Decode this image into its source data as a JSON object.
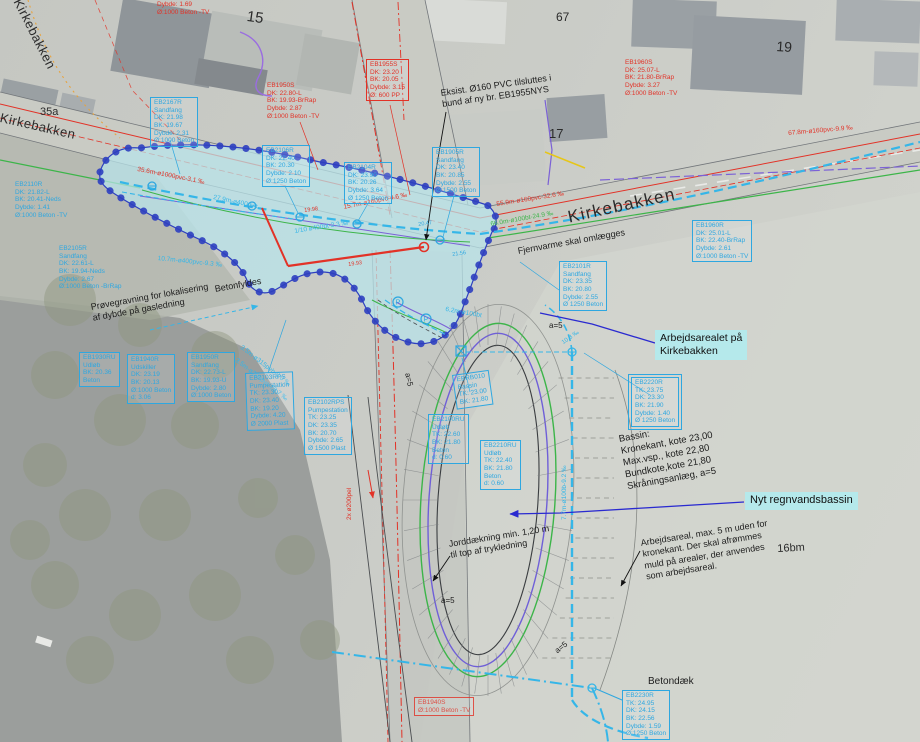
{
  "road_labels": {
    "main": "Kirkebakken",
    "top_left": "Kirkebakken",
    "left": "Kirkebakken"
  },
  "highlights": {
    "arbejdsarealet_line1": "Arbejdsarealet på",
    "arbejdsarealet_line2": "Kirkebakken",
    "nyt": "Nyt regnvandsbassin"
  },
  "colors": {
    "blue": "#2ea7e0",
    "red": "#e23227",
    "green": "#3cb549",
    "purple": "#7b61d6",
    "cyan": "#35b6e8",
    "darkblue": "#2a2ad0",
    "cloud": "#2d3fc0",
    "highlight": "#b5e9eb"
  },
  "house_numbers": [
    {
      "t": "15",
      "x": 248,
      "y": 8,
      "s": 15,
      "r": 8
    },
    {
      "t": "67",
      "x": 556,
      "y": 10,
      "s": 12,
      "r": 0
    },
    {
      "t": "19",
      "x": 777,
      "y": 38,
      "s": 14,
      "r": 4
    },
    {
      "t": "17",
      "x": 549,
      "y": 126,
      "s": 13,
      "r": 0
    },
    {
      "t": "35a",
      "x": 40,
      "y": 106,
      "s": 11,
      "r": 0
    },
    {
      "t": "16bm",
      "x": 777,
      "y": 543,
      "s": 11,
      "r": -3
    }
  ],
  "annotations": [
    {
      "lines": [
        "Eksist. Ø160 PVC tilsluttes i",
        "bund af ny br. EB1955NYS"
      ],
      "x": 440,
      "y": 88,
      "r": -8,
      "s": 9
    },
    {
      "lines": [
        "Fjernvarme skal omlægges"
      ],
      "x": 517,
      "y": 246,
      "r": -10,
      "s": 9
    },
    {
      "lines": [
        "Betonfyldes"
      ],
      "x": 214,
      "y": 284,
      "r": -10,
      "s": 9
    },
    {
      "lines": [
        "Prøvegravning for lokalisering",
        "af dybde på gasledning"
      ],
      "x": 90,
      "y": 302,
      "r": -10,
      "s": 9
    },
    {
      "lines": [
        "Bassin:",
        "Kronekant, kote 23,00",
        "Max.vsp., kote 22,80",
        "Bundkote,kote 21,80",
        "Skråningsanlæg, a=5"
      ],
      "x": 618,
      "y": 434,
      "r": -10,
      "s": 9.5
    },
    {
      "lines": [
        "Jorddækning min. 1,20 m",
        "til top af trykledning"
      ],
      "x": 448,
      "y": 539,
      "r": -9,
      "s": 9
    },
    {
      "lines": [
        "Arbejdsareal, max. 5 m uden for",
        "kronekant. Der skal afrømmes",
        "muld på arealer, der anvendes",
        "som arbejdsareal."
      ],
      "x": 640,
      "y": 538,
      "r": -9,
      "s": 9
    },
    {
      "lines": [
        "Betondæk"
      ],
      "x": 648,
      "y": 676,
      "r": 0,
      "s": 10
    },
    {
      "lines": [
        "a=5"
      ],
      "x": 549,
      "y": 321,
      "r": 0,
      "s": 8
    },
    {
      "lines": [
        "a=5"
      ],
      "x": 412,
      "y": 372,
      "r": 78,
      "s": 8
    },
    {
      "lines": [
        "a=5"
      ],
      "x": 441,
      "y": 596,
      "r": 0,
      "s": 8
    },
    {
      "lines": [
        "a=5"
      ],
      "x": 553,
      "y": 648,
      "r": -38,
      "s": 8
    }
  ],
  "pipe_labels": [
    {
      "t": "67.8m-ø160pvc-9.9 ‰",
      "x": 788,
      "y": 130,
      "r": -5,
      "c": "red"
    },
    {
      "t": "55.9m-ø160pvc-32.6 ‰",
      "x": 496,
      "y": 201,
      "r": -9,
      "c": "red"
    },
    {
      "t": "66.0m-ø100bt-24.9 ‰",
      "x": 490,
      "y": 221,
      "r": -10,
      "c": "green"
    },
    {
      "t": "35.6m-ø1000pvc-3.1 ‰",
      "x": 138,
      "y": 166,
      "r": 11,
      "c": "red"
    },
    {
      "t": "27.9m-ø400pvc",
      "x": 214,
      "y": 194,
      "r": 12,
      "c": "cyan"
    },
    {
      "t": "10.7m-ø400pvc-9.3 ‰",
      "x": 158,
      "y": 255,
      "r": 6,
      "c": "cyan"
    },
    {
      "t": "15.7m-ø160pvc-4.6 ‰",
      "x": 343,
      "y": 204,
      "r": -11,
      "c": "red"
    },
    {
      "t": "1/10 ø400bt-2.3 ‰",
      "x": 294,
      "y": 228,
      "r": -9,
      "c": "cyan"
    },
    {
      "t": "3.5m-ø315peh-0.0 ‰",
      "x": 243,
      "y": 344,
      "r": 38,
      "c": "cyan"
    },
    {
      "t": "3.5m-ø200pvc-26.7 ‰",
      "x": 238,
      "y": 357,
      "r": 38,
      "c": "cyan"
    },
    {
      "t": "7.7m-ø100b-9.2 ‰",
      "x": 561,
      "y": 520,
      "r": -90,
      "c": "cyan"
    },
    {
      "t": "2x ø200pel",
      "x": 346,
      "y": 520,
      "r": -90,
      "c": "red"
    },
    {
      "t": "6.2m-ø100bt",
      "x": 446,
      "y": 306,
      "r": 10,
      "c": "cyan"
    },
    {
      "t": "10.3 ‰",
      "x": 561,
      "y": 341,
      "r": -35,
      "c": "cyan",
      "s": 6
    },
    {
      "t": "19.98",
      "x": 304,
      "y": 208,
      "r": -8,
      "c": "red",
      "s": 5.5
    },
    {
      "t": "19.93",
      "x": 348,
      "y": 262,
      "r": -8,
      "c": "red",
      "s": 5.5
    },
    {
      "t": "20.47",
      "x": 418,
      "y": 222,
      "r": -8,
      "c": "blue",
      "s": 5.5
    },
    {
      "t": "21.56",
      "x": 452,
      "y": 252,
      "r": -8,
      "c": "blue",
      "s": 5.5
    }
  ],
  "manhole_boxes": [
    {
      "id": "EB2167R",
      "style": "b",
      "x": 150,
      "y": 97,
      "lines": [
        "EB2167R",
        "Sandfang",
        "DK: 21.98",
        "BK: 19.67",
        "Dybde: 2.31",
        "Ø:1000 Beton"
      ]
    },
    {
      "id": "EB1950S",
      "style": "rb",
      "x": 267,
      "y": 82,
      "lines": [
        "EB1950S",
        "DK: 22.80-L",
        "BK: 19.93-BrRap",
        "Dybde: 2.87",
        "Ø:1000 Beton -TV"
      ]
    },
    {
      "id": "EB1955S",
      "style": "r",
      "x": 366,
      "y": 59,
      "lines": [
        "EB1955S",
        "DK: 23.20",
        "BK: 20.05",
        "Dybde: 3.15",
        "Ø: 600 PP"
      ]
    },
    {
      "id": "EB2106R",
      "style": "b",
      "x": 262,
      "y": 145,
      "lines": [
        "EB2106R",
        "DK: 22.40",
        "BK: 20.30",
        "Dybde: 2.10",
        "Ø:1250 Beton"
      ]
    },
    {
      "id": "EB2104R",
      "style": "b",
      "x": 344,
      "y": 162,
      "lines": [
        "EB2104R",
        "DK: 23.90",
        "BK: 20.26",
        "Dybde: 3.64",
        "Ø 1250 Beton"
      ]
    },
    {
      "id": "EB1905R",
      "style": "b",
      "x": 432,
      "y": 147,
      "lines": [
        "EB1905R",
        "Sandfang",
        "DK: 23.40",
        "BK: 20.85",
        "Dybde: 2.55",
        "Ø:1500 Beton"
      ]
    },
    {
      "id": "EB1960S",
      "style": "rb",
      "x": 625,
      "y": 59,
      "lines": [
        "EB1960S",
        "DK: 25.07-L",
        "BK: 21.80-BrRap",
        "Dybde: 3.27",
        "Ø:1000 Beton -TV"
      ]
    },
    {
      "id": "EB1960R",
      "style": "b",
      "x": 692,
      "y": 220,
      "lines": [
        "EB1960R",
        "DK: 25.01-L",
        "BK: 22.40-BrRap",
        "Dybde: 2.61",
        "Ø:1000 Beton -TV"
      ]
    },
    {
      "id": "EB2110R",
      "style": "bb",
      "x": 15,
      "y": 181,
      "lines": [
        "EB2110R",
        "DK: 21.82-L",
        "BK: 20.41-Neds",
        "Dybde: 1.41",
        "Ø:1000 Beton -TV"
      ]
    },
    {
      "id": "EB2105R",
      "style": "bb",
      "x": 59,
      "y": 245,
      "lines": [
        "EB2105R",
        "Sandfang",
        "DK: 22.61-L",
        "BK: 19.94-Neds",
        "Dybde: 2.67",
        "Ø:1000 Beton -BrRap"
      ]
    },
    {
      "id": "EB2101R",
      "style": "b",
      "x": 559,
      "y": 261,
      "lines": [
        "EB2101R",
        "Sandfang",
        "DK: 23.35",
        "BK: 20.80",
        "Dybde: 2.55",
        "Ø 1250 Beton"
      ]
    },
    {
      "id": "EB1930RU",
      "style": "b",
      "x": 79,
      "y": 352,
      "lines": [
        "EB1930RU",
        "Udløb",
        "BK: 20.36",
        "Beton"
      ]
    },
    {
      "id": "EB1940R",
      "style": "b",
      "x": 127,
      "y": 354,
      "lines": [
        "EB1940R",
        "Udskiller",
        "DK: 23.19",
        "BK: 20.13",
        "Ø:1000 Beton",
        "d: 3.06"
      ]
    },
    {
      "id": "EB1950R",
      "style": "b",
      "x": 187,
      "y": 352,
      "lines": [
        "EB1950R",
        "Sandfang",
        "DK: 22.73-L",
        "BK: 19.93-U",
        "Dybde: 2.80",
        "Ø:1000 Beton"
      ]
    },
    {
      "id": "EB2103RPS",
      "style": "b",
      "x": 245,
      "y": 373,
      "rot": -2,
      "lines": [
        "EB2103RPS",
        "Pumpestation",
        "TK: 23.30",
        "DK: 23.40",
        "BK: 19.20",
        "Dybde: 4.20",
        "Ø 2000 Plast"
      ]
    },
    {
      "id": "EB2102RPS",
      "style": "b",
      "x": 304,
      "y": 397,
      "lines": [
        "EB2102RPS",
        "Pumpestation",
        "TK: 23.25",
        "DK: 23.35",
        "BK: 20.70",
        "Dybde: 2.65",
        "Ø 1500 Plast"
      ]
    },
    {
      "id": "EBRB010",
      "style": "b",
      "x": 452,
      "y": 375,
      "rot": -8,
      "lines": [
        "EBRB010",
        "Bassin",
        "TK: 23.00",
        "BK: 21.80"
      ]
    },
    {
      "id": "EB2100RU",
      "style": "b",
      "x": 428,
      "y": 414,
      "lines": [
        "EB2100RU",
        "Udløb",
        "TK: 22.60",
        "BK: 21.80",
        "Beton",
        "d: 0.60"
      ]
    },
    {
      "id": "EB2210RU",
      "style": "b",
      "x": 480,
      "y": 440,
      "lines": [
        "EB2210RU",
        "Udløb",
        "TK: 22.40",
        "BK: 21.80",
        "Beton",
        "d: 0.60"
      ]
    },
    {
      "id": "EB2220R",
      "style": "bd",
      "x": 631,
      "y": 377,
      "lines": [
        "EB2220R",
        "TK: 23.75",
        "DK: 23.30",
        "BK: 21.90",
        "Dybde: 1.40",
        "Ø 1250 Beton"
      ]
    },
    {
      "id": "EB2230R",
      "style": "b",
      "x": 622,
      "y": 690,
      "lines": [
        "EB2230R",
        "TK: 24.95",
        "DK: 24.15",
        "BK: 22.56",
        "Dybde: 1.59",
        "Ø:1250 Beton"
      ]
    },
    {
      "id": "EB1940S",
      "style": "r",
      "x": 414,
      "y": 697,
      "op": 0.8,
      "lines": [
        "EB1940S",
        "Ø:1000 Beton -TV"
      ]
    },
    {
      "id": "DYBDE-1-69",
      "style": "rb",
      "x": 157,
      "y": 1,
      "lines": [
        "Dybde: 1.69",
        "Ø:1000 Beton -TV"
      ]
    }
  ],
  "symbols": [
    {
      "k": "mh",
      "x": 152,
      "y": 186
    },
    {
      "k": "mh",
      "x": 252,
      "y": 206
    },
    {
      "k": "mh",
      "x": 300,
      "y": 217
    },
    {
      "k": "mh",
      "x": 357,
      "y": 224
    },
    {
      "k": "mh",
      "x": 440,
      "y": 240
    },
    {
      "k": "p",
      "x": 398,
      "y": 302
    },
    {
      "k": "p",
      "x": 426,
      "y": 319
    },
    {
      "k": "red",
      "x": 424,
      "y": 247
    },
    {
      "k": "sq",
      "x": 456,
      "y": 346
    },
    {
      "k": "mh2",
      "x": 572,
      "y": 352
    },
    {
      "k": "mh2",
      "x": 592,
      "y": 688
    }
  ]
}
